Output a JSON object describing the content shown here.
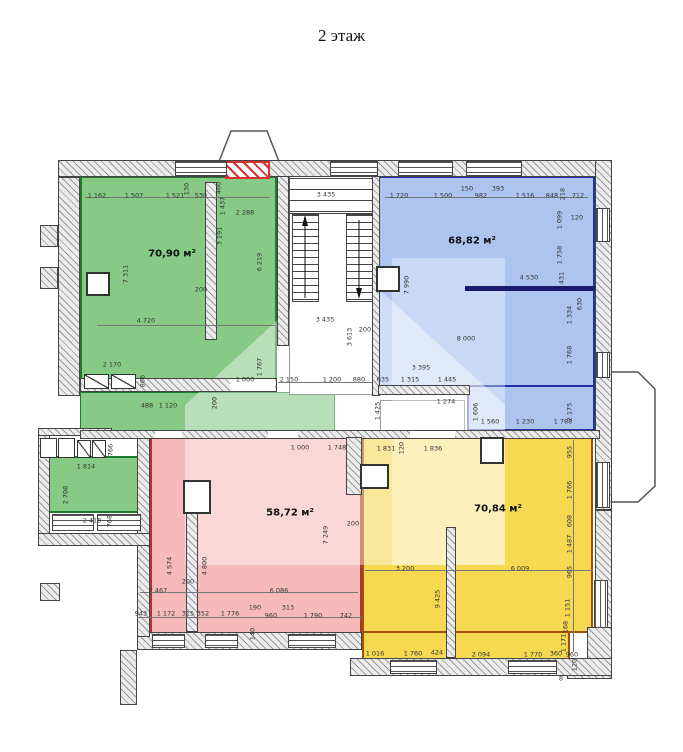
{
  "title": "2 этаж",
  "colors": {
    "green_fill": "#86ca86",
    "green_border": "#1e7a2e",
    "blue_fill": "#adc4ee",
    "blue_border": "#2233aa",
    "pink_fill": "#f6baba",
    "pink_border": "#b03333",
    "yellow_fill": "#f6d851",
    "yellow_border": "#a0520a",
    "red_hatch": "#d93030",
    "dim_text": "#333333"
  },
  "rooms": [
    {
      "id": "green",
      "label": "70,90 м²"
    },
    {
      "id": "blue",
      "label": "68,82 м²"
    },
    {
      "id": "pink",
      "label": "58,72 м²"
    },
    {
      "id": "yellow",
      "label": "70,84 м²"
    }
  ],
  "dimensions": [
    {
      "t": "1 162",
      "x": 97,
      "y": 196
    },
    {
      "t": "1 507",
      "x": 134,
      "y": 196
    },
    {
      "t": "1 521",
      "x": 175,
      "y": 196
    },
    {
      "t": "530",
      "x": 201,
      "y": 196
    },
    {
      "t": "130",
      "x": 187,
      "y": 189,
      "r": 1
    },
    {
      "t": "460",
      "x": 219,
      "y": 188,
      "r": 1
    },
    {
      "t": "1 437",
      "x": 223,
      "y": 206,
      "r": 1
    },
    {
      "t": "2 288",
      "x": 245,
      "y": 213
    },
    {
      "t": "3 191",
      "x": 220,
      "y": 236,
      "r": 1
    },
    {
      "t": "6 219",
      "x": 260,
      "y": 262,
      "r": 1
    },
    {
      "t": "7 311",
      "x": 126,
      "y": 274,
      "r": 1
    },
    {
      "t": "200",
      "x": 201,
      "y": 290
    },
    {
      "t": "4 720",
      "x": 146,
      "y": 321
    },
    {
      "t": "2 170",
      "x": 112,
      "y": 365
    },
    {
      "t": "866",
      "x": 143,
      "y": 381,
      "r": 1
    },
    {
      "t": "1 767",
      "x": 260,
      "y": 367,
      "r": 1
    },
    {
      "t": "488",
      "x": 147,
      "y": 406
    },
    {
      "t": "1 120",
      "x": 168,
      "y": 406
    },
    {
      "t": "200",
      "x": 215,
      "y": 403,
      "r": 1
    },
    {
      "t": "1 000",
      "x": 245,
      "y": 380
    },
    {
      "t": "3 435",
      "x": 326,
      "y": 195
    },
    {
      "t": "3 435",
      "x": 325,
      "y": 320
    },
    {
      "t": "3 613",
      "x": 350,
      "y": 337,
      "r": 1
    },
    {
      "t": "200",
      "x": 365,
      "y": 330
    },
    {
      "t": "2 150",
      "x": 289,
      "y": 380
    },
    {
      "t": "1 200",
      "x": 332,
      "y": 380
    },
    {
      "t": "880",
      "x": 359,
      "y": 380
    },
    {
      "t": "1 425",
      "x": 378,
      "y": 411,
      "r": 1
    },
    {
      "t": "1 274",
      "x": 446,
      "y": 402
    },
    {
      "t": "1 720",
      "x": 399,
      "y": 196
    },
    {
      "t": "1 500",
      "x": 443,
      "y": 196
    },
    {
      "t": "150",
      "x": 467,
      "y": 189
    },
    {
      "t": "982",
      "x": 481,
      "y": 196
    },
    {
      "t": "393",
      "x": 498,
      "y": 189
    },
    {
      "t": "1 516",
      "x": 525,
      "y": 196
    },
    {
      "t": "848",
      "x": 552,
      "y": 196
    },
    {
      "t": "218",
      "x": 563,
      "y": 194,
      "r": 1
    },
    {
      "t": "712",
      "x": 578,
      "y": 196
    },
    {
      "t": "1 099",
      "x": 560,
      "y": 220,
      "r": 1
    },
    {
      "t": "120",
      "x": 577,
      "y": 218
    },
    {
      "t": "1 758",
      "x": 560,
      "y": 255,
      "r": 1
    },
    {
      "t": "431",
      "x": 562,
      "y": 278,
      "r": 1
    },
    {
      "t": "4 530",
      "x": 529,
      "y": 278
    },
    {
      "t": "7 990",
      "x": 407,
      "y": 285,
      "r": 1
    },
    {
      "t": "8 000",
      "x": 466,
      "y": 339
    },
    {
      "t": "3 395",
      "x": 421,
      "y": 368
    },
    {
      "t": "635",
      "x": 383,
      "y": 380
    },
    {
      "t": "1 315",
      "x": 410,
      "y": 380
    },
    {
      "t": "1 445",
      "x": 447,
      "y": 380
    },
    {
      "t": "1 334",
      "x": 570,
      "y": 315,
      "r": 1
    },
    {
      "t": "630",
      "x": 580,
      "y": 304,
      "r": 1
    },
    {
      "t": "1 768",
      "x": 570,
      "y": 355,
      "r": 1
    },
    {
      "t": "2 175",
      "x": 570,
      "y": 412,
      "r": 1
    },
    {
      "t": "1 606",
      "x": 476,
      "y": 412,
      "r": 1
    },
    {
      "t": "1 560",
      "x": 490,
      "y": 422
    },
    {
      "t": "1 230",
      "x": 525,
      "y": 422
    },
    {
      "t": "1 788",
      "x": 563,
      "y": 422
    },
    {
      "t": "1 000",
      "x": 300,
      "y": 448
    },
    {
      "t": "1 748",
      "x": 337,
      "y": 448
    },
    {
      "t": "7 249",
      "x": 326,
      "y": 535,
      "r": 1
    },
    {
      "t": "200",
      "x": 353,
      "y": 524
    },
    {
      "t": "4 574",
      "x": 170,
      "y": 566,
      "r": 1
    },
    {
      "t": "4 800",
      "x": 205,
      "y": 566,
      "r": 1
    },
    {
      "t": "200",
      "x": 188,
      "y": 582
    },
    {
      "t": "2 467",
      "x": 158,
      "y": 591
    },
    {
      "t": "6 086",
      "x": 279,
      "y": 591
    },
    {
      "t": "943",
      "x": 141,
      "y": 614
    },
    {
      "t": "1 172",
      "x": 166,
      "y": 614
    },
    {
      "t": "315",
      "x": 188,
      "y": 614
    },
    {
      "t": "352",
      "x": 203,
      "y": 614
    },
    {
      "t": "1 776",
      "x": 230,
      "y": 614
    },
    {
      "t": "190",
      "x": 255,
      "y": 608
    },
    {
      "t": "960",
      "x": 271,
      "y": 616
    },
    {
      "t": "313",
      "x": 288,
      "y": 608
    },
    {
      "t": "1 790",
      "x": 313,
      "y": 616
    },
    {
      "t": "742",
      "x": 346,
      "y": 616
    },
    {
      "t": "140",
      "x": 253,
      "y": 634,
      "r": 1
    },
    {
      "t": "1 814",
      "x": 86,
      "y": 467
    },
    {
      "t": "766",
      "x": 111,
      "y": 450,
      "r": 1
    },
    {
      "t": "2 708",
      "x": 66,
      "y": 495,
      "r": 1
    },
    {
      "t": "2 418",
      "x": 92,
      "y": 521
    },
    {
      "t": "768",
      "x": 110,
      "y": 521,
      "r": 1
    },
    {
      "t": "1 831",
      "x": 386,
      "y": 449
    },
    {
      "t": "120",
      "x": 402,
      "y": 448,
      "r": 1
    },
    {
      "t": "1 836",
      "x": 433,
      "y": 449
    },
    {
      "t": "955",
      "x": 570,
      "y": 452,
      "r": 1
    },
    {
      "t": "1 766",
      "x": 570,
      "y": 490,
      "r": 1
    },
    {
      "t": "608",
      "x": 570,
      "y": 521,
      "r": 1
    },
    {
      "t": "1 487",
      "x": 570,
      "y": 544,
      "r": 1
    },
    {
      "t": "965",
      "x": 570,
      "y": 572,
      "r": 1
    },
    {
      "t": "3 200",
      "x": 405,
      "y": 569
    },
    {
      "t": "6 009",
      "x": 520,
      "y": 569
    },
    {
      "t": "9 425",
      "x": 438,
      "y": 599,
      "r": 1
    },
    {
      "t": "1 151",
      "x": 568,
      "y": 608,
      "r": 1
    },
    {
      "t": "168",
      "x": 566,
      "y": 627,
      "r": 1
    },
    {
      "t": "1 171",
      "x": 564,
      "y": 643,
      "r": 1
    },
    {
      "t": "1 016",
      "x": 375,
      "y": 654
    },
    {
      "t": "1 760",
      "x": 413,
      "y": 654
    },
    {
      "t": "424",
      "x": 437,
      "y": 653
    },
    {
      "t": "2 094",
      "x": 481,
      "y": 655
    },
    {
      "t": "1 770",
      "x": 533,
      "y": 655
    },
    {
      "t": "360",
      "x": 556,
      "y": 654
    },
    {
      "t": "960",
      "x": 572,
      "y": 655
    },
    {
      "t": "120",
      "x": 575,
      "y": 665,
      "r": 1
    },
    {
      "t": "8",
      "x": 561,
      "y": 679
    }
  ]
}
